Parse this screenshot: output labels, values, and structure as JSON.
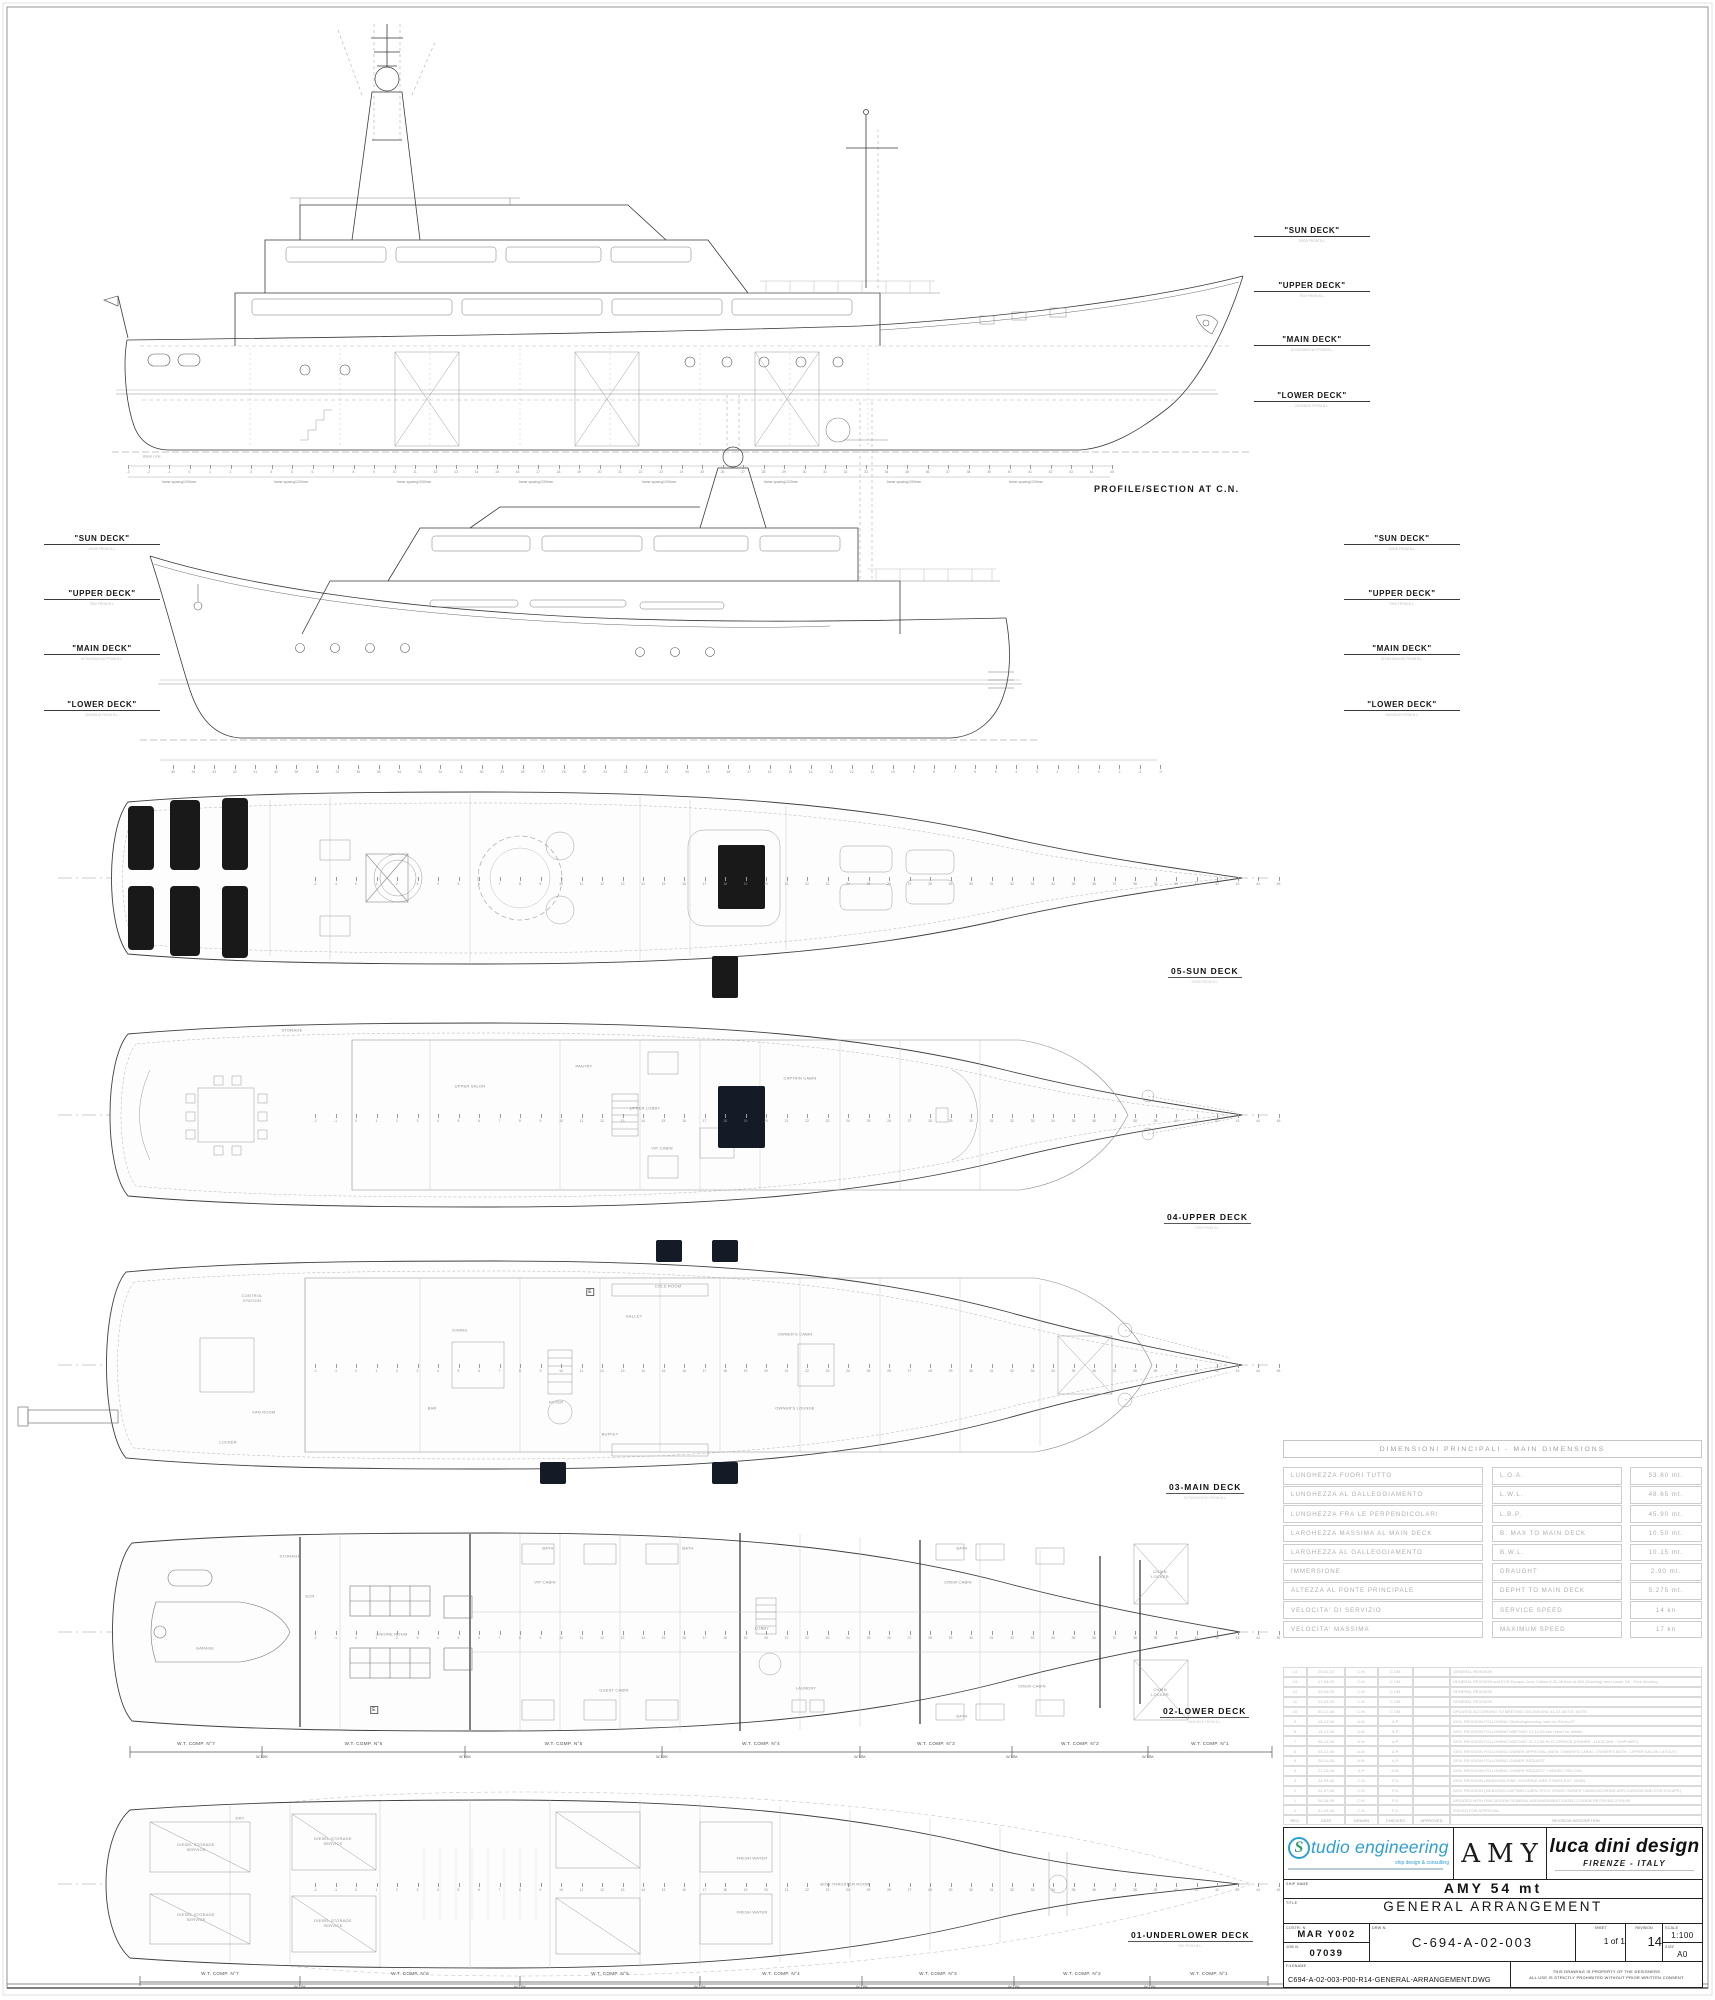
{
  "captions": {
    "profile_section": "PROFILE/SECTION AT C.N.",
    "base_line": "Base Line"
  },
  "deck_label_columns": [
    {
      "x": 1254,
      "rows": [
        {
          "y": 226,
          "label": "\"SUN DECK\"",
          "sub": "10535 FROM B.L."
        },
        {
          "y": 281,
          "label": "\"UPPER DECK\"",
          "sub": "7900 FROM B.L."
        },
        {
          "y": 335,
          "label": "\"MAIN DECK\"",
          "sub": "5275/4150/4740 FROM B.L."
        },
        {
          "y": 391,
          "label": "\"LOWER DECK\"",
          "sub": "2600/3615 FROM B.L."
        }
      ]
    },
    {
      "x": 44,
      "rows": [
        {
          "y": 534,
          "label": "\"SUN DECK\"",
          "sub": "10535 FROM B.L."
        },
        {
          "y": 589,
          "label": "\"UPPER DECK\"",
          "sub": "7900 FROM B.L."
        },
        {
          "y": 644,
          "label": "\"MAIN DECK\"",
          "sub": "5275/4150/4740 FROM B.L."
        },
        {
          "y": 700,
          "label": "\"LOWER DECK\"",
          "sub": "2600/3615 FROM B.L."
        }
      ]
    },
    {
      "x": 1344,
      "rows": [
        {
          "y": 534,
          "label": "\"SUN DECK\"",
          "sub": "10535 FROM B.L."
        },
        {
          "y": 589,
          "label": "\"UPPER DECK\"",
          "sub": "7900 FROM B.L."
        },
        {
          "y": 644,
          "label": "\"MAIN DECK\"",
          "sub": "5275/4150/4740 FROM B.L."
        },
        {
          "y": 700,
          "label": "\"LOWER DECK\"",
          "sub": "2600/3615 FROM B.L."
        }
      ]
    }
  ],
  "plans": [
    {
      "label": "05-SUN DECK",
      "sub": "10535 FROM B.L."
    },
    {
      "label": "04-UPPER DECK",
      "sub": "7900 FROM B.L."
    },
    {
      "label": "03-MAIN DECK",
      "sub": "5275/4150/4740 FROM B.L."
    },
    {
      "label": "02-LOWER DECK",
      "sub": "2600/3615 FROM B.L."
    },
    {
      "label": "01-UNDERLOWER DECK",
      "sub": "650 FROM B.L."
    }
  ],
  "rulers": [
    {
      "y": 470,
      "x0": 128,
      "step": 20.5,
      "from": -3,
      "to": 45,
      "rev": false
    },
    {
      "y": 770,
      "x0": 173,
      "step": 20.57,
      "from": -3,
      "to": 45,
      "rev": true
    },
    {
      "y": 882,
      "x0": 315,
      "step": 20.5,
      "from": -2,
      "to": 45,
      "rev": false
    },
    {
      "y": 1119,
      "x0": 315,
      "step": 20.5,
      "from": -2,
      "to": 45,
      "rev": false
    },
    {
      "y": 1369,
      "x0": 315,
      "step": 20.5,
      "from": -2,
      "to": 45,
      "rev": false
    },
    {
      "y": 1636,
      "x0": 315,
      "step": 20.5,
      "from": -2,
      "to": 45,
      "rev": false
    },
    {
      "y": 1888,
      "x0": 315,
      "step": 20.5,
      "from": -2,
      "to": 45,
      "rev": false
    }
  ],
  "frame_spacing": {
    "y": 480,
    "items": [
      {
        "x": 179,
        "t": "frame spacing1000mm"
      },
      {
        "x": 291,
        "t": "frame spacing1200mm"
      },
      {
        "x": 414,
        "t": "frame spacing1000mm"
      },
      {
        "x": 536,
        "t": "frame spacing1200mm"
      },
      {
        "x": 659,
        "t": "frame spacing1000mm"
      },
      {
        "x": 781,
        "t": "frame spacing1200mm"
      },
      {
        "x": 904,
        "t": "frame spacing1000mm"
      },
      {
        "x": 1026,
        "t": "frame spacing1200mm"
      }
    ]
  },
  "wt_rows": [
    {
      "line_y": 1752,
      "label_y": 1746,
      "bk_y": 1755,
      "bounds": [
        130,
        262,
        465,
        662,
        860,
        1012,
        1148,
        1272
      ],
      "labels": [
        "W.T. COMP. N°7",
        "W.T. COMP. N°6",
        "W.T. COMP. N°5",
        "W.T. COMP. N°4",
        "W.T. COMP. N°3",
        "W.T. COMP. N°2",
        "W.T. COMP. N°1"
      ],
      "bk": "W.T.BK"
    },
    {
      "line_y": 1982,
      "label_y": 1976,
      "bk_y": 1985,
      "bounds": [
        140,
        300,
        520,
        700,
        862,
        1014,
        1150,
        1268
      ],
      "labels": [
        "W.T. COMP. N°7",
        "W.T. COMP. N°6",
        "W.T. COMP. N°5",
        "W.T. COMP. N°4",
        "W.T. COMP. N°3",
        "W.T. COMP. N°2",
        "W.T. COMP. N°1"
      ],
      "bk": "W.T.BK"
    }
  ],
  "annotations": [
    {
      "x": 152,
      "y": 457,
      "t": "Base Line",
      "cls": "it"
    },
    {
      "x": 292,
      "y": 1030,
      "t": "STORAGE"
    },
    {
      "x": 470,
      "y": 1086,
      "t": "UPPER SALON"
    },
    {
      "x": 584,
      "y": 1066,
      "t": "PANTRY"
    },
    {
      "x": 645,
      "y": 1108,
      "t": "UPPER LOBBY"
    },
    {
      "x": 662,
      "y": 1148,
      "t": "VIP CABIN"
    },
    {
      "x": 800,
      "y": 1078,
      "t": "CAPTAIN CABIN"
    },
    {
      "x": 252,
      "y": 1298,
      "t": "CONTROL\nSTATION"
    },
    {
      "x": 460,
      "y": 1330,
      "t": "DINING"
    },
    {
      "x": 634,
      "y": 1316,
      "t": "GALLEY"
    },
    {
      "x": 668,
      "y": 1286,
      "t": "COLD ROOM"
    },
    {
      "x": 795,
      "y": 1334,
      "t": "OWNER'S CABIN"
    },
    {
      "x": 795,
      "y": 1408,
      "t": "OWNER'S LOUNGE"
    },
    {
      "x": 556,
      "y": 1402,
      "t": "FOYER"
    },
    {
      "x": 432,
      "y": 1408,
      "t": "BAR"
    },
    {
      "x": 610,
      "y": 1434,
      "t": "BUFFET"
    },
    {
      "x": 264,
      "y": 1412,
      "t": "FAN ROOM"
    },
    {
      "x": 228,
      "y": 1442,
      "t": "LOCKER"
    },
    {
      "x": 590,
      "y": 1292,
      "t": "E",
      "cls": "eb"
    },
    {
      "x": 205,
      "y": 1648,
      "t": "GARAGE"
    },
    {
      "x": 310,
      "y": 1596,
      "t": "ECR"
    },
    {
      "x": 392,
      "y": 1634,
      "t": "ENGINE ROOM"
    },
    {
      "x": 545,
      "y": 1582,
      "t": "VIP CABIN"
    },
    {
      "x": 614,
      "y": 1690,
      "t": "GUEST CABIN"
    },
    {
      "x": 762,
      "y": 1628,
      "t": "LOBBY"
    },
    {
      "x": 806,
      "y": 1688,
      "t": "LAUNDRY"
    },
    {
      "x": 958,
      "y": 1582,
      "t": "CREW CABIN"
    },
    {
      "x": 1032,
      "y": 1686,
      "t": "CREW CABIN"
    },
    {
      "x": 290,
      "y": 1556,
      "t": "STORAGE"
    },
    {
      "x": 548,
      "y": 1548,
      "t": "BATH"
    },
    {
      "x": 688,
      "y": 1548,
      "t": "BATH"
    },
    {
      "x": 962,
      "y": 1548,
      "t": "BATH"
    },
    {
      "x": 962,
      "y": 1716,
      "t": "BATH"
    },
    {
      "x": 1160,
      "y": 1574,
      "t": "CHAIN\nLOCKER"
    },
    {
      "x": 1160,
      "y": 1692,
      "t": "CHAIN\nLOCKER"
    },
    {
      "x": 374,
      "y": 1710,
      "t": "E",
      "cls": "eb"
    },
    {
      "x": 240,
      "y": 1818,
      "t": "DRY"
    },
    {
      "x": 196,
      "y": 1847,
      "t": "DIESEL STORAGE\nSERVICE"
    },
    {
      "x": 196,
      "y": 1917,
      "t": "DIESEL STORAGE\nSERVICE"
    },
    {
      "x": 333,
      "y": 1841,
      "t": "DIESEL STORAGE\nSERVICE"
    },
    {
      "x": 333,
      "y": 1923,
      "t": "DIESEL STORAGE\nSERVICE"
    },
    {
      "x": 752,
      "y": 1858,
      "t": "FRESH WATER"
    },
    {
      "x": 752,
      "y": 1912,
      "t": "FRESH WATER"
    },
    {
      "x": 845,
      "y": 1884,
      "t": "BOW THRUSTER ROOM"
    }
  ],
  "dims_table": {
    "header": "DIMENSIONI PRINCIPALI - MAIN DIMENSIONS",
    "rows": [
      [
        "LUNGHEZZA FUORI TUTTO",
        "L.O.A.",
        "53.80 mt."
      ],
      [
        "LUNGHEZZA AL GALLEGGIAMENTO",
        "L.W.L.",
        "48.65 mt."
      ],
      [
        "LUNGHEZZA FRA LE PERPENDICOLARI",
        "L.B.P.",
        "45.90 mt."
      ],
      [
        "LARGHEZZA MASSIMA AL MAIN DECK",
        "B. MAX TO MAIN DECK",
        "10.50 mt."
      ],
      [
        "LARGHEZZA AL GALLEGGIAMENTO",
        "B.W.L.",
        "10.15 mt."
      ],
      [
        "IMMERSIONE",
        "DRAUGHT",
        "2.90 mt."
      ],
      [
        "ALTEZZA AL PONTE PRINCIPALE",
        "DEPHT TO MAIN DECK",
        "5.275 mt."
      ],
      [
        "VELOCITA' DI SERVIZIO",
        "SERVICE SPEED",
        "14 kn"
      ],
      [
        "VELOCITA' MASSIMA",
        "MAXIMUM SPEED",
        "17 kn"
      ]
    ]
  },
  "rev_table": {
    "header": [
      "REV.",
      "DATE",
      "DRAWN",
      "CHECKED",
      "APPROVED",
      "REVISION DESCRIPTION"
    ],
    "rows": [
      [
        "14",
        "29-01-10",
        "C.M.",
        "C.CM.",
        "",
        "GENERAL REVISION"
      ],
      [
        "13",
        "17-06-09",
        "C.M.",
        "C.CM.",
        "",
        "GENERAL REVISION and ECR Escape-Crew Cabins fr.30-38 floor at 660 (finishing) from Lower DK - Fore Mooring"
      ],
      [
        "12",
        "30-04-09",
        "C.M.",
        "C.CM.",
        "",
        "GENERAL REVISION"
      ],
      [
        "11",
        "13-03-09",
        "C.M.",
        "C.CM.",
        "",
        "GENERAL REVISION"
      ],
      [
        "10",
        "30-12-08",
        "C.M.",
        "C.CM.",
        "",
        "UPDATED ACCORDING TO MEETING 15/12/08 AND 31-12-08 S.E. NOTE"
      ],
      [
        "9",
        "15-12-08",
        "A.M.",
        "A.P.",
        "",
        "GEN. REVISION FOLLOWING Studioengineering note for GA rev.07"
      ],
      [
        "8",
        "15-12-08",
        "A.M.",
        "A.P.",
        "",
        "GEN. REVISION FOLLOWING MEETING 12-12-08  see report for details"
      ],
      [
        "7",
        "04-12-08",
        "A.M.",
        "A.P.",
        "",
        "GEN. REVISION FOLLOWING MEETING 01-12-08 IN FLORENCE (OWNER - LUCA DINI - SHIPYARD)"
      ],
      [
        "6",
        "03-12-08",
        "A.M.",
        "A.P.",
        "",
        "GEN. REVISION FOLLOWING OWNER APPROVAL (NEW: OWNER'S CABIN - OWNER'S BATH - UPPER SALON LAYOUT)"
      ],
      [
        "5",
        "03-11-08",
        "A.M.",
        "A.P.",
        "",
        "GEN. REVISION FOLLOWING OWNER REQUEST"
      ],
      [
        "4",
        "21-10-08",
        "A.P.",
        "A.M.",
        "",
        "GEN. REVISION FOLLOWING OWNER REQUEST + ADDED FAN COIL"
      ],
      [
        "3",
        "24-09-08",
        "C.M.",
        "F.G.",
        "",
        "GEN. REVISION (WINDOWS-FWD. MOORING ARR-STAIRS-EXT. VIEW)"
      ],
      [
        "2",
        "22-07-08",
        "C.M.",
        "F.G.",
        "",
        "GEN. REVISION (WINDOWS-CAPTAIN CABIN-TECH. SPACE OWNER CABIN-MOORING ARR-GARAGE AND ECR ESCAPE)"
      ],
      [
        "1",
        "06-05-08",
        "C.M.",
        "F.G.",
        "",
        "UPDATED WITH DINI DESIGN GENERAL ARRANGEMENT DATED 27/03/08 RECEIVED 07/04/08"
      ],
      [
        "0",
        "31-03-08",
        "C.M.",
        "F.G.",
        "",
        "ISSUED FOR APPROVAL"
      ]
    ]
  },
  "title_block": {
    "logo1": {
      "s": "S",
      "brand": "tudio engineering",
      "tagline": "ship design & consulting"
    },
    "logo2": "AMY",
    "logo3": {
      "brand": "luca dini design",
      "city": "FIRENZE - ITALY"
    },
    "ship_name_label": "SHIP NAME",
    "ship_name": "AMY 54 mt",
    "title_label": "TITLE",
    "title": "GENERAL ARRANGEMENT",
    "costr_label": "COSTR. N.",
    "costr": "MAR Y002",
    "job_label": "JOB N.",
    "job": "07039",
    "drw_label": "DRW N.",
    "drw": "C-694-A-02-003",
    "sheet_label": "SHEET",
    "sheet": "1 of 1",
    "revision_label": "REVISION",
    "revision": "14",
    "scale_label": "SCALE",
    "scale": "1:100",
    "size_label": "SIZE",
    "size": "A0",
    "filename_label": "FILENAME",
    "filename": "C694-A-02-003-P00-R14-GENERAL-ARRANGEMENT.DWG",
    "property_line1": "THIS DRAWING IS PROPERTY OF THE DESIGNERS",
    "property_line2": "ALL USE IS STRICTLY PROHIBITED WITHOUT PRIOR WRITTEN CONSENT"
  }
}
